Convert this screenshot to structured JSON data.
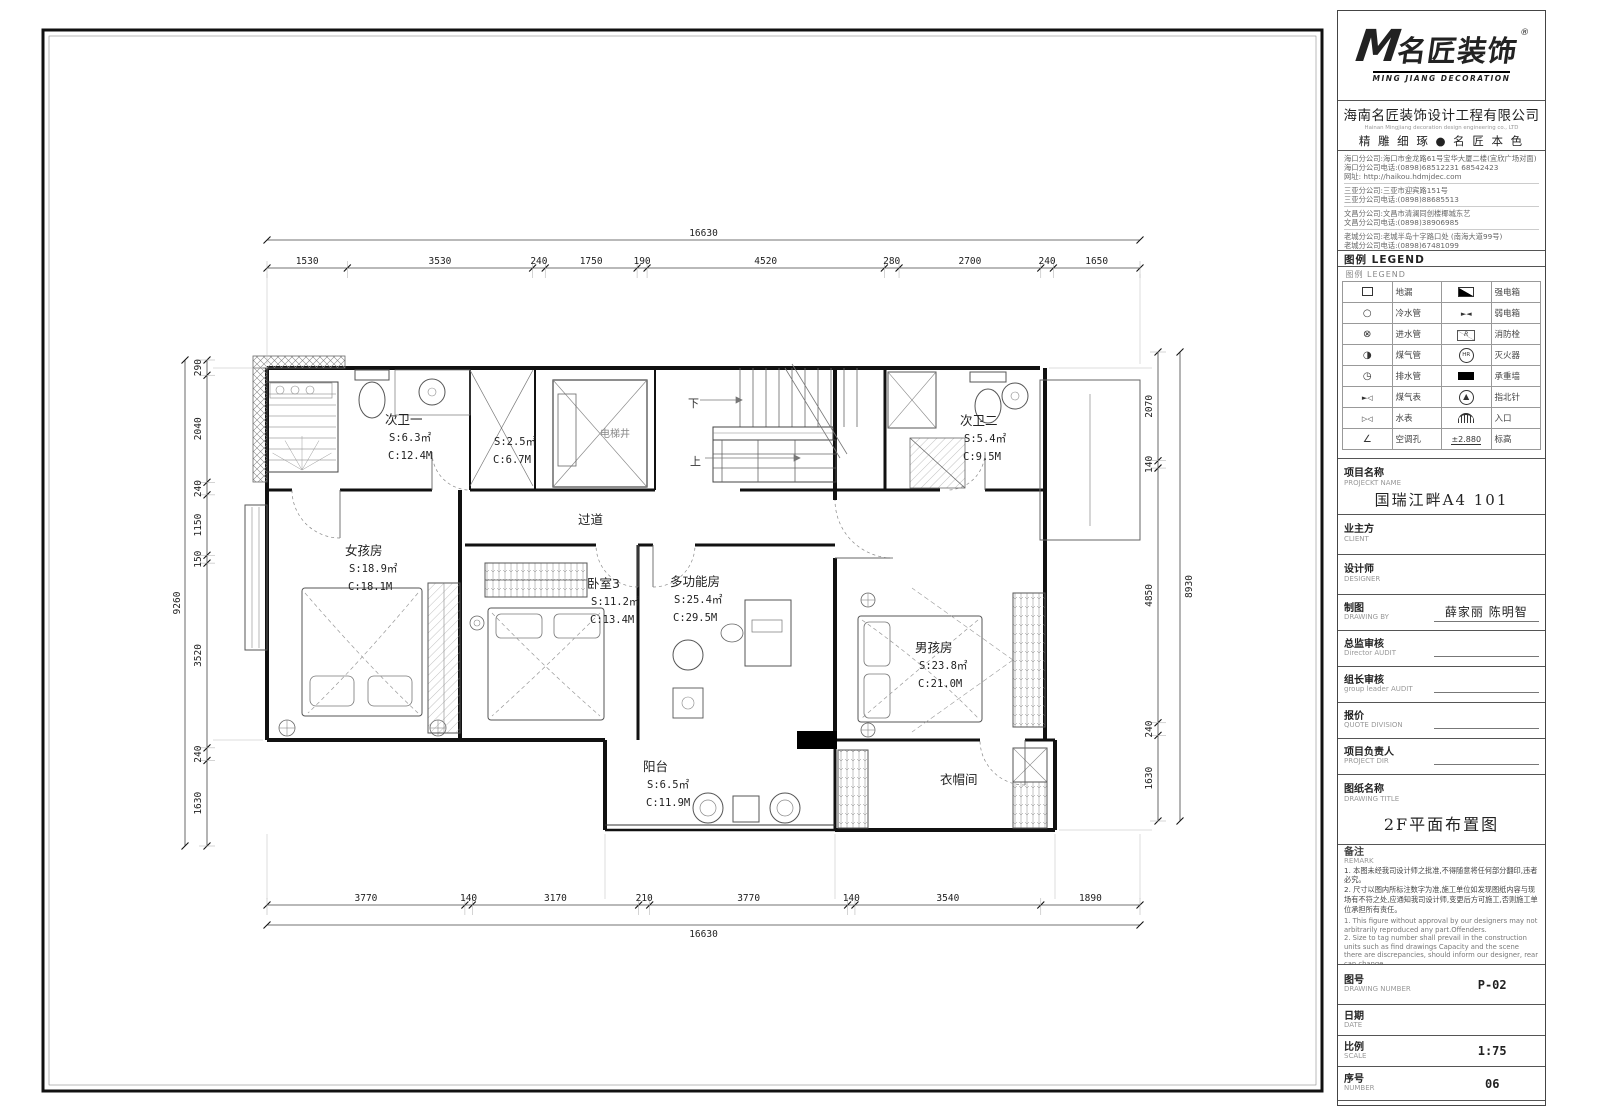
{
  "title_block": {
    "logo": {
      "m": "M",
      "brand": "名匠装饰",
      "registered": "®",
      "sub": "MING JIANG DECORATION"
    },
    "company": {
      "name": "海南名匠装饰设计工程有限公司",
      "name_en": "Hainan Mingjiang decoration design engineering co., LTD",
      "slogan": "精 雕 细 琢 ● 名 匠 本 色"
    },
    "branch_groups": [
      [
        "海口分公司:海口市金龙路61号宝华大厦二楼(宜欣广场对面)",
        "海口分公司电话:(0898)68512231 68542423",
        "网址: http://haikou.hdmjdec.com"
      ],
      [
        "三亚分公司:三亚市迎宾路151号",
        "三亚分公司电话:(0898)88685513"
      ],
      [
        "文昌分公司:文昌市清澜同创楼椰城东艺",
        "文昌分公司电话:(0898)38906985"
      ],
      [
        "老城分公司:老城半岛十字路口处 (南海大道99号)",
        "老城分公司电话:(0898)67481099"
      ]
    ],
    "legend_title": "图例  LEGEND",
    "legend_caption": "图例  LEGEND",
    "legend_rows": [
      {
        "s1": "floor-drain",
        "l1": "地漏",
        "s2": "strong-elec-box",
        "l2": "强电箱"
      },
      {
        "s1": "cold-water-pipe",
        "l1": "冷水管",
        "s2": "weak-elec-box",
        "l2": "弱电箱"
      },
      {
        "s1": "inlet-water-pipe",
        "l1": "进水管",
        "s2": "fire-hydrant",
        "l2": "消防栓"
      },
      {
        "s1": "gas-pipe",
        "l1": "煤气管",
        "s2": "fire-extinguisher",
        "l2": "灭火器"
      },
      {
        "s1": "drain-pipe",
        "l1": "排水管",
        "s2": "bearing-wall",
        "l2": "承重墙"
      },
      {
        "s1": "gas-meter",
        "l1": "煤气表",
        "s2": "north-arrow",
        "l2": "指北针"
      },
      {
        "s1": "water-meter",
        "l1": "水表",
        "s2": "entrance",
        "l2": "入口"
      },
      {
        "s1": "ac-hole",
        "l1": "空调孔",
        "s2": "elevation",
        "l2": "标高",
        "s2_text": "±2.880"
      }
    ],
    "fields": [
      {
        "id": "project-name",
        "label": "项目名称",
        "sub": "PROJECKT NAME",
        "value": "国瑞江畔A4 101",
        "type": "big",
        "h": 56,
        "fs": 15
      },
      {
        "id": "client",
        "label": "业主方",
        "sub": "CLIENT",
        "value": "",
        "type": "big",
        "h": 40,
        "fs": 12
      },
      {
        "id": "designer",
        "label": "设计师",
        "sub": "DESIGNER",
        "value": "",
        "type": "big",
        "h": 40,
        "fs": 12
      },
      {
        "id": "drawing-by",
        "label": "制图",
        "sub": "DRAWING BY",
        "value": "薛家丽 陈明智",
        "type": "inline",
        "h": 36,
        "fs": 12
      },
      {
        "id": "director-audit",
        "label": "总监审核",
        "sub": "Director AUDIT",
        "value": "",
        "type": "inline",
        "h": 36,
        "fs": 11
      },
      {
        "id": "leader-audit",
        "label": "组长审核",
        "sub": "group leader AUDIT",
        "value": "",
        "type": "inline",
        "h": 36,
        "fs": 11
      },
      {
        "id": "quote",
        "label": "报价",
        "sub": "QUOTE DIVISION",
        "value": "",
        "type": "inline",
        "h": 36,
        "fs": 11
      },
      {
        "id": "project-dir",
        "label": "项目负责人",
        "sub": "PROJECT DIR",
        "value": "",
        "type": "inline",
        "h": 36,
        "fs": 11
      },
      {
        "id": "drawing-title",
        "label": "图纸名称",
        "sub": "DRAWING TITLE",
        "value": "2F平面布置图",
        "type": "big",
        "h": 70,
        "fs": 16
      }
    ],
    "remark": {
      "label": "备注",
      "sub": "REMARK",
      "cn": [
        "本图未经我司设计师之批准,不得随意将任何部分翻印,违者必究。",
        "尺寸以图内所标注数字为准,施工单位如发现图纸内容与现场有不符之处,应通知我司设计师,变更后方可施工,否则施工单位承担所有责任。"
      ],
      "en": [
        "This figure without approval by our designers may not arbitrarily reproduced any part.Offenders.",
        "Size to tag number shall prevail in the construction units such as find drawings Capacity and the scene there are discrepancies, should inform our designer, rear can change"
      ]
    },
    "bottom_fields": [
      {
        "id": "drawing-number",
        "label": "图号",
        "sub": "DRAWING NUMBER",
        "value": "P-02",
        "h": 40
      },
      {
        "id": "date",
        "label": "日期",
        "sub": "DATE",
        "value": "",
        "h": 31
      },
      {
        "id": "scale",
        "label": "比例",
        "sub": "SCALE",
        "value": "1:75",
        "h": 31
      },
      {
        "id": "number",
        "label": "序号",
        "sub": "NUMBER",
        "value": "06",
        "h": 34
      }
    ]
  },
  "plan": {
    "rooms": [
      {
        "id": "cw1",
        "name": "次卫一",
        "s": "S:6.3㎡",
        "c": "C:12.4M"
      },
      {
        "id": "store",
        "name": "",
        "s": "S:2.5㎡",
        "c": "C:6.7M"
      },
      {
        "id": "girl",
        "name": "女孩房",
        "s": "S:18.9㎡",
        "c": "C:18.1M"
      },
      {
        "id": "br3",
        "name": "卧室3",
        "s": "S:11.2㎡",
        "c": "C:13.4M"
      },
      {
        "id": "multi",
        "name": "多功能房",
        "s": "S:25.4㎡",
        "c": "C:29.5M"
      },
      {
        "id": "cw2",
        "name": "次卫二",
        "s": "S:5.4㎡",
        "c": "C:9.5M"
      },
      {
        "id": "boy",
        "name": "男孩房",
        "s": "S:23.8㎡",
        "c": "C:21.0M"
      },
      {
        "id": "balcony",
        "name": "阳台",
        "s": "S:6.5㎡",
        "c": "C:11.9M"
      }
    ],
    "labels": [
      {
        "id": "corridor",
        "text": "过道"
      },
      {
        "id": "cloakroom",
        "text": "衣帽间"
      },
      {
        "id": "elevator",
        "text": "电梯井"
      },
      {
        "id": "stair-down",
        "text": "下"
      },
      {
        "id": "stair-up",
        "text": "上"
      }
    ],
    "dims": {
      "top": {
        "total": 16630,
        "segs": [
          1530,
          3530,
          240,
          1750,
          190,
          4520,
          280,
          2700,
          240,
          1650
        ]
      },
      "bottom": {
        "total": 16630,
        "segs": [
          3770,
          140,
          3170,
          210,
          3770,
          140,
          3540,
          1890
        ]
      },
      "left": {
        "total": 9260,
        "segs": [
          290,
          2040,
          240,
          1150,
          150,
          3520,
          240,
          1630
        ]
      },
      "right": {
        "total": 8930,
        "segs": [
          2070,
          140,
          4850,
          240,
          1630
        ]
      }
    }
  }
}
